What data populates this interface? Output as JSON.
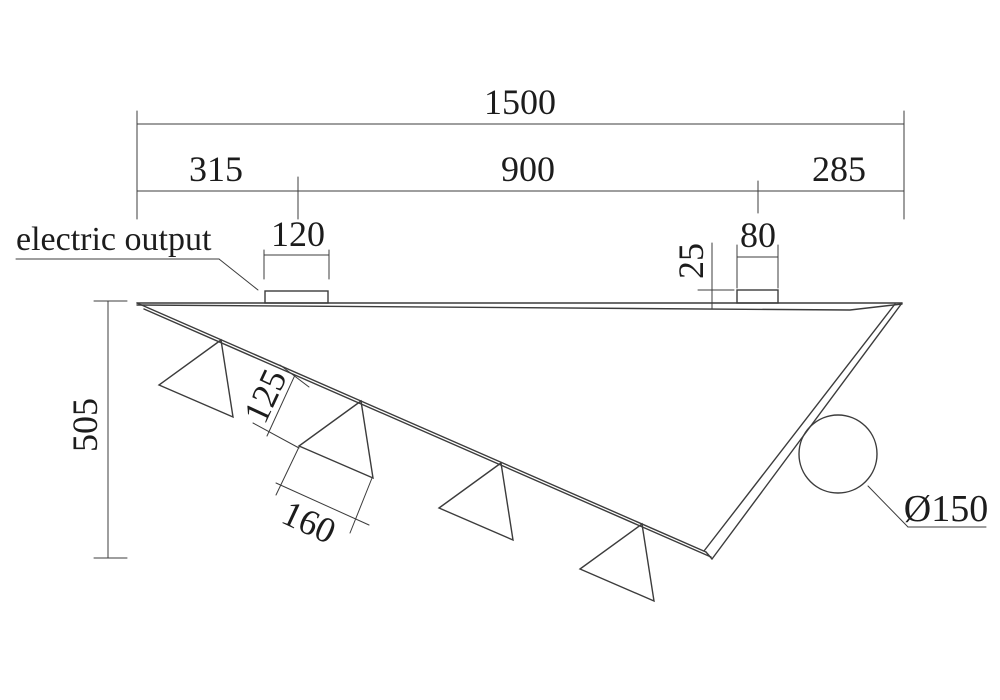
{
  "drawing": {
    "callouts": {
      "electric_output": "electric output",
      "diameter": "Ø150"
    },
    "dimensions": {
      "total_length": "1500",
      "segment_left": "315",
      "segment_middle": "900",
      "segment_right": "285",
      "connector_left_width": "120",
      "connector_right_width": "80",
      "connector_height": "25",
      "overall_height": "505",
      "fin_offset": "125",
      "fin_base": "160"
    },
    "colors": {
      "line": "#3c3c3c",
      "text": "#1c1c1c",
      "background": "#ffffff"
    }
  }
}
